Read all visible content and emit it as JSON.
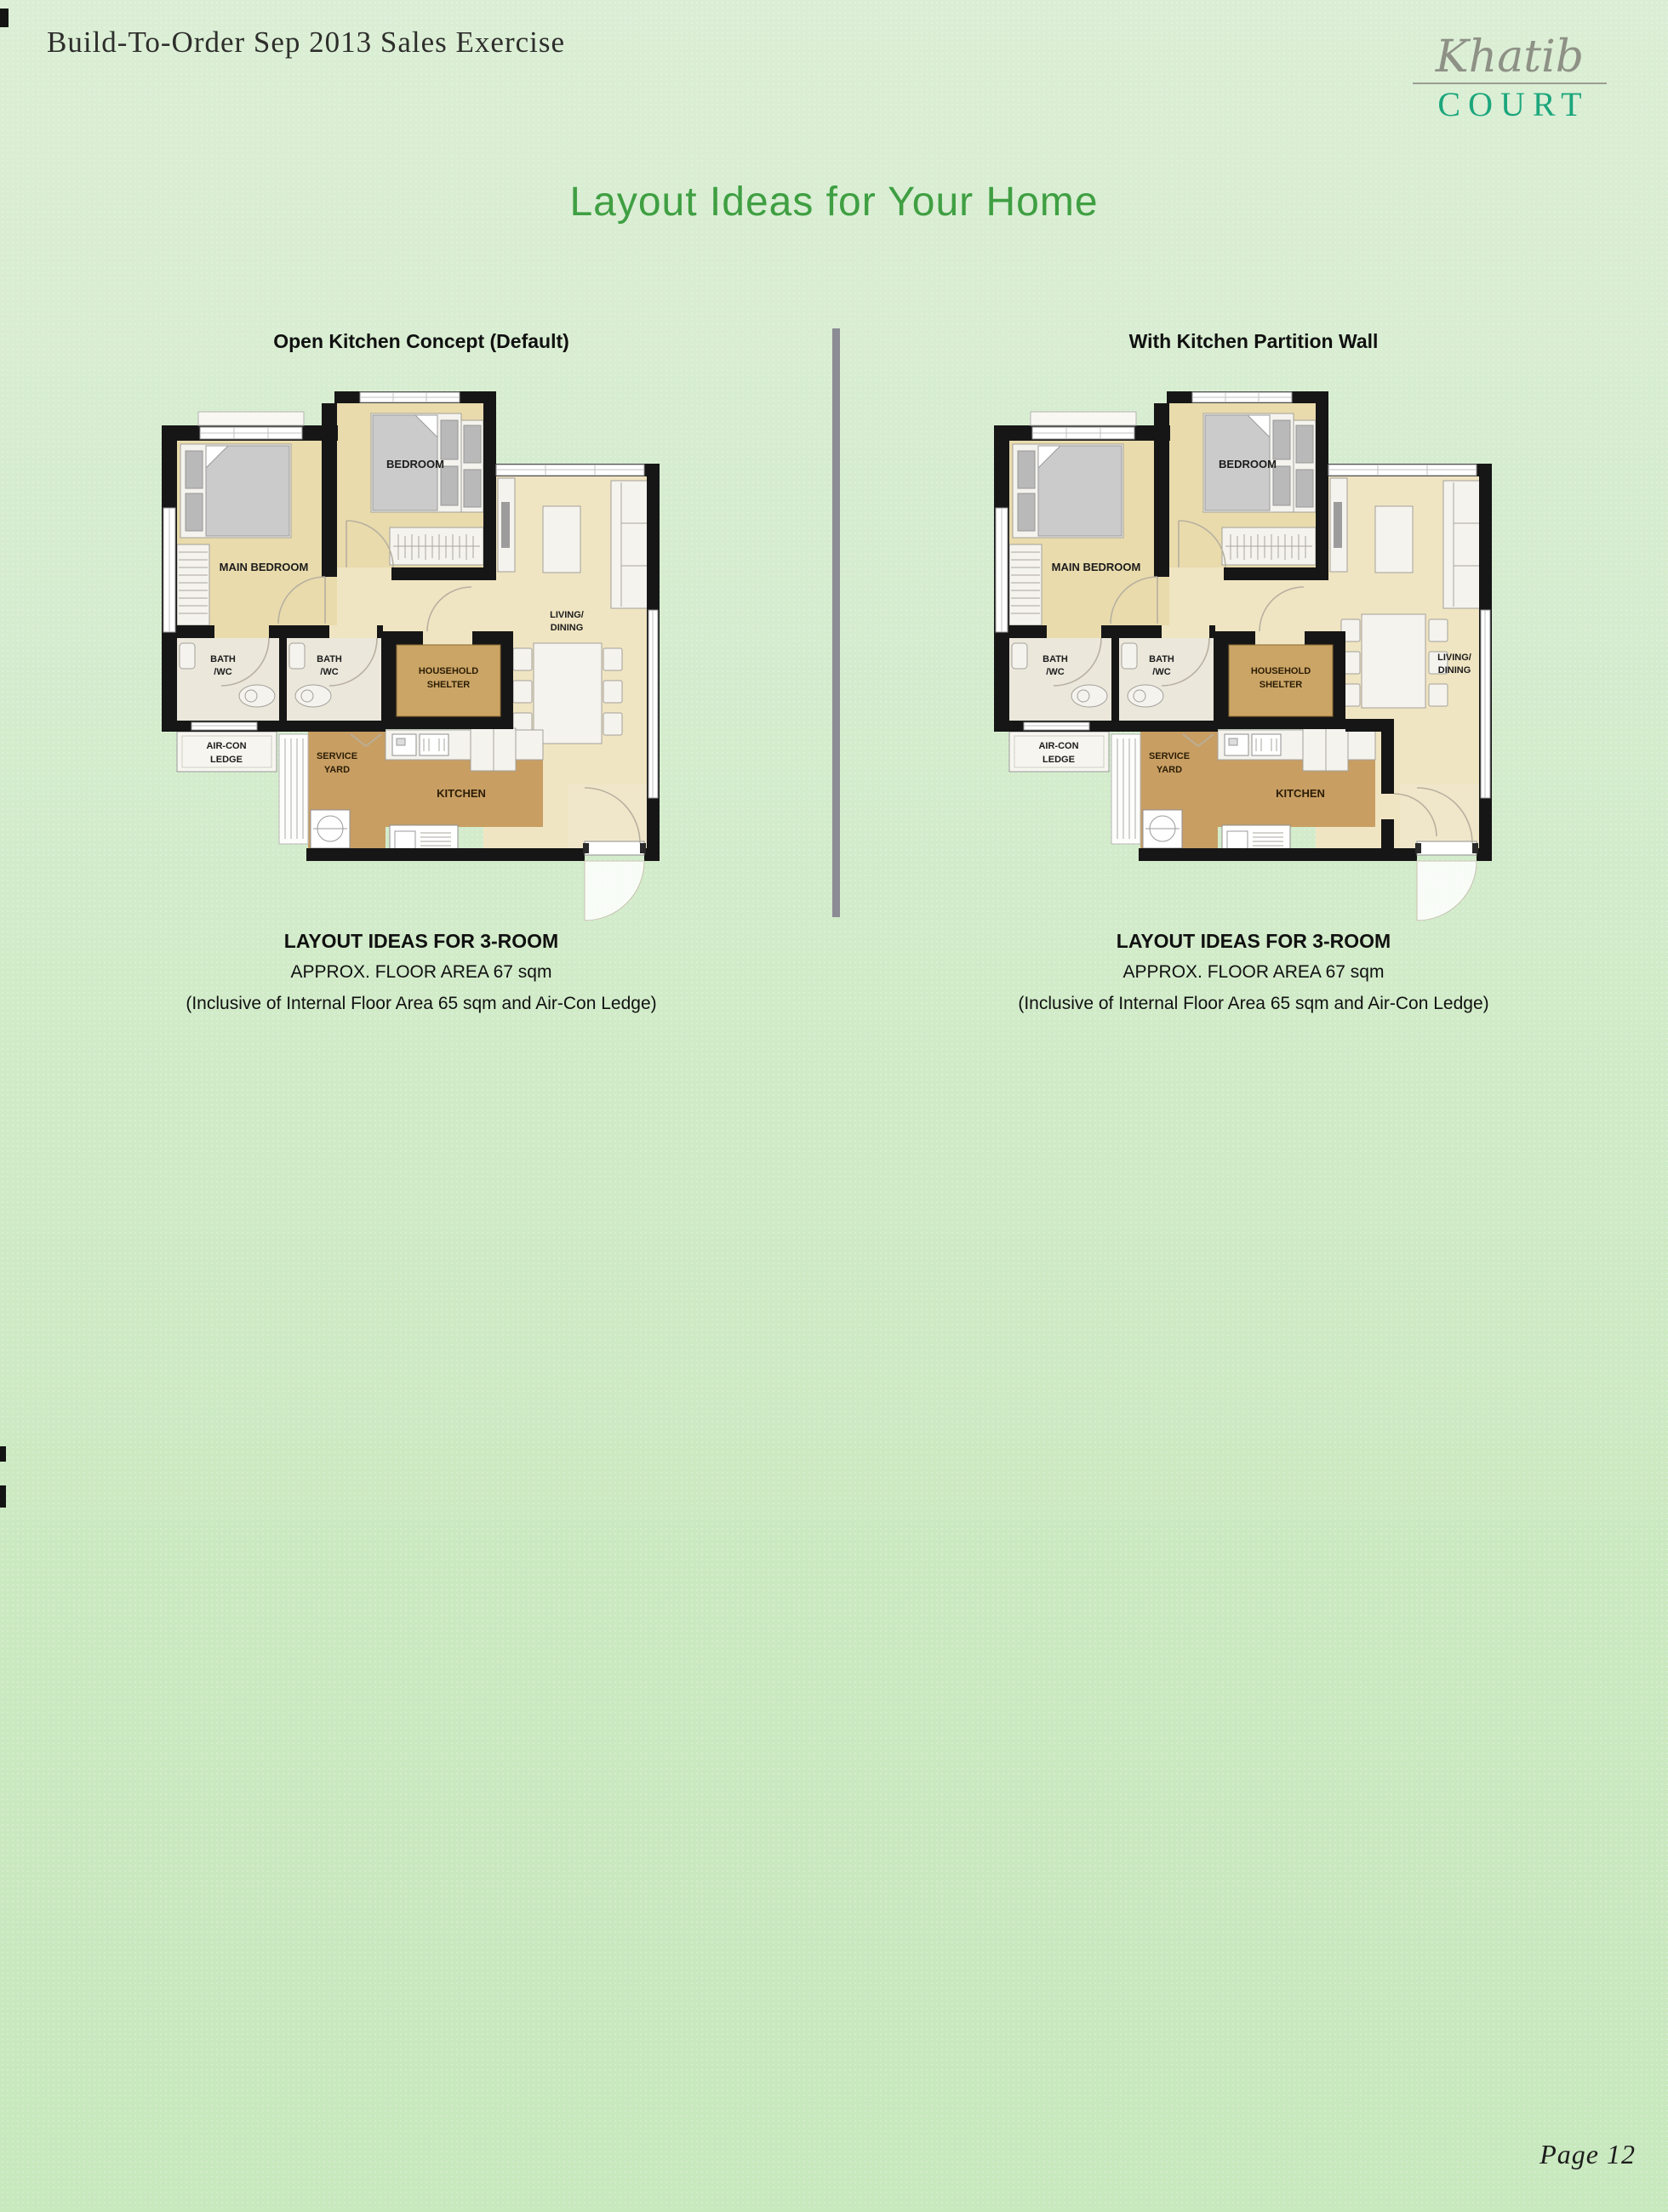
{
  "page": {
    "header_title": "Build-To-Order Sep 2013 Sales Exercise",
    "title": "Layout Ideas for Your Home",
    "footer_page": "Page 12"
  },
  "logo": {
    "script": "Khatib",
    "block": "COURT"
  },
  "plans": [
    {
      "heading": "Open Kitchen Concept (Default)",
      "caption_line1": "LAYOUT IDEAS FOR 3-ROOM",
      "caption_line2": "APPROX. FLOOR AREA 67 sqm",
      "caption_line3": "(Inclusive of Internal Floor Area 65 sqm and Air-Con Ledge)"
    },
    {
      "heading": "With Kitchen Partition Wall",
      "caption_line1": "LAYOUT IDEAS FOR 3-ROOM",
      "caption_line2": "APPROX. FLOOR AREA 67 sqm",
      "caption_line3": "(Inclusive of Internal Floor Area 65 sqm and Air-Con Ledge)"
    }
  ],
  "room_labels": {
    "main_bedroom": "MAIN BEDROOM",
    "bedroom": "BEDROOM",
    "living_line1": "LIVING/",
    "living_line2": "DINING",
    "bath_line1": "BATH",
    "bath_line2": "/WC",
    "household_line1": "HOUSEHOLD",
    "household_line2": "SHELTER",
    "aircon_line1": "AIR-CON",
    "aircon_line2": "LEDGE",
    "service_line1": "SERVICE",
    "service_line2": "YARD",
    "kitchen": "KITCHEN"
  },
  "colors": {
    "title_green": "#3f9f42",
    "logo_teal": "#1ca67c",
    "logo_gray": "#8e9186",
    "divider_gray": "#8c8c94",
    "wall_black": "#161616",
    "floor_beige": "#e9dbac",
    "floor_light": "#f0e5c2",
    "floor_brown": "#c89e63",
    "floor_bath": "#ebe7db"
  }
}
